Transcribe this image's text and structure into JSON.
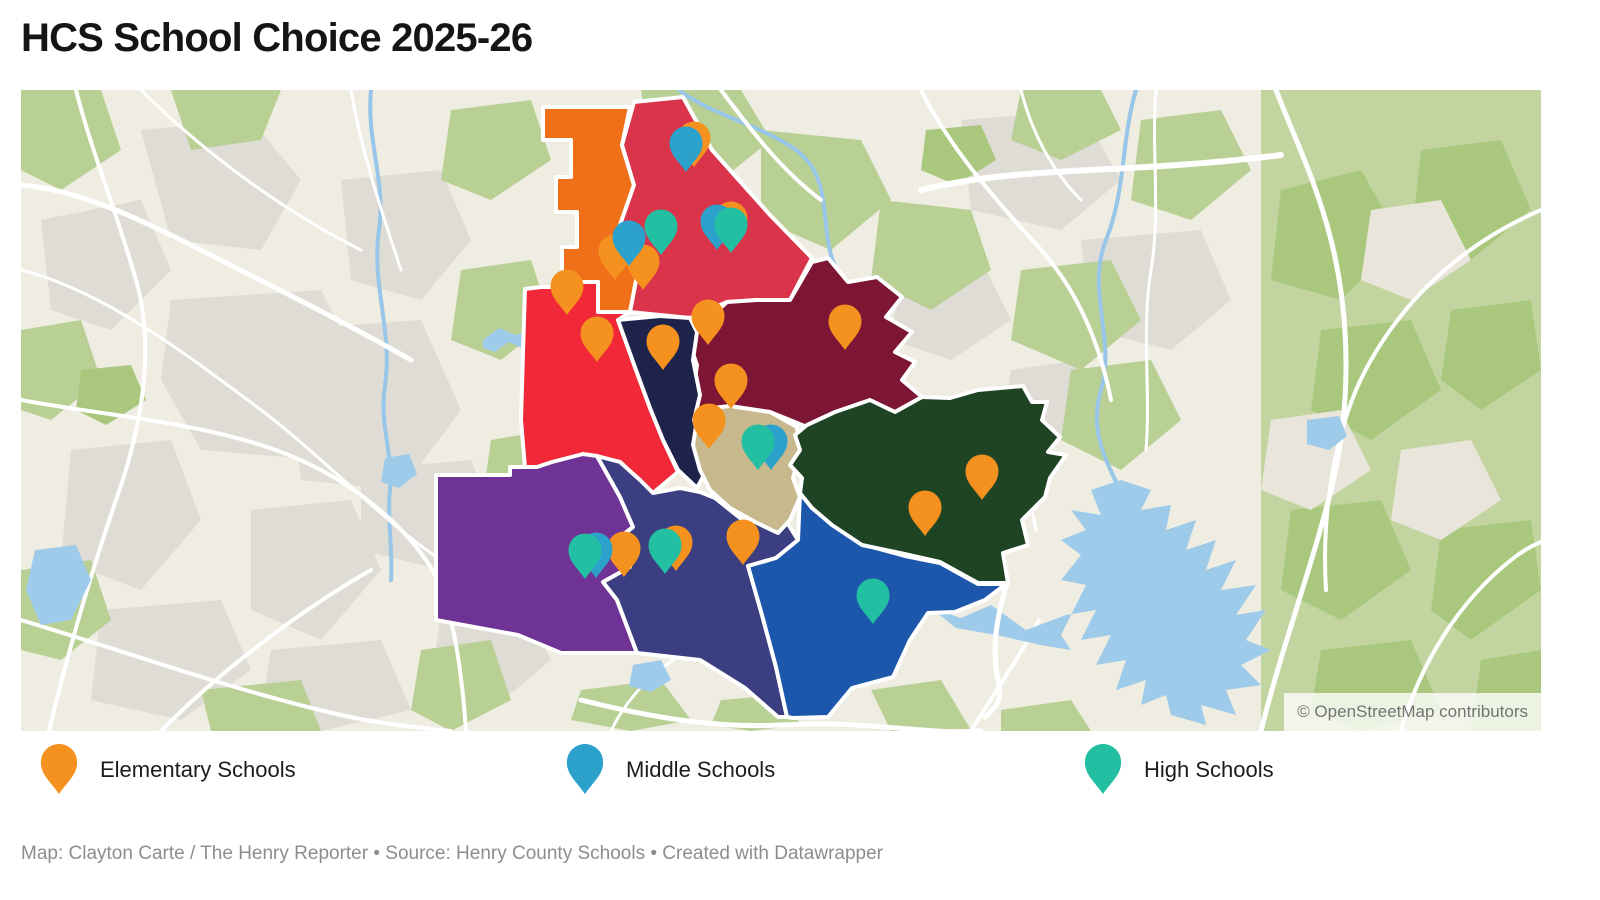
{
  "title": "HCS School Choice 2025-26",
  "legend": {
    "items": [
      {
        "type": "elementary",
        "label": "Elementary Schools",
        "color": "#F5911E"
      },
      {
        "type": "middle",
        "label": "Middle Schools",
        "color": "#2BA1CB"
      },
      {
        "type": "high",
        "label": "High Schools",
        "color": "#22BFA2"
      }
    ]
  },
  "map": {
    "attribution": "© OpenStreetMap contributors",
    "basemap_colors": {
      "land": "#EFECE2",
      "urban": "#DEDCD4",
      "vegetation": "#B9D095",
      "forest": "#C2D5A1",
      "water": "#9FCBEA",
      "road": "#FFFFFF"
    },
    "districts": [
      {
        "id": "northwest-orange",
        "color": "#F07019"
      },
      {
        "id": "north-crimson",
        "color": "#D9344A"
      },
      {
        "id": "west-red",
        "color": "#F02837"
      },
      {
        "id": "east-maroon",
        "color": "#7D1535"
      },
      {
        "id": "central-navy",
        "color": "#1D234B"
      },
      {
        "id": "central-tan",
        "color": "#C7B98D"
      },
      {
        "id": "east-green",
        "color": "#1E4423"
      },
      {
        "id": "southwest-purple",
        "color": "#6E3394"
      },
      {
        "id": "south-indigo",
        "color": "#3B3E80"
      },
      {
        "id": "southeast-blue",
        "color": "#1D57AB"
      }
    ],
    "markers": [
      {
        "type": "elementary",
        "x": 594,
        "y": 190
      },
      {
        "type": "elementary",
        "x": 622,
        "y": 200
      },
      {
        "type": "middle",
        "x": 608,
        "y": 176
      },
      {
        "type": "high",
        "x": 640,
        "y": 165
      },
      {
        "type": "elementary",
        "x": 673,
        "y": 77
      },
      {
        "type": "middle",
        "x": 665,
        "y": 82
      },
      {
        "type": "elementary",
        "x": 710,
        "y": 157
      },
      {
        "type": "middle",
        "x": 696,
        "y": 160
      },
      {
        "type": "high",
        "x": 710,
        "y": 163
      },
      {
        "type": "elementary",
        "x": 546,
        "y": 225
      },
      {
        "type": "elementary",
        "x": 576,
        "y": 272
      },
      {
        "type": "elementary",
        "x": 642,
        "y": 280
      },
      {
        "type": "elementary",
        "x": 687,
        "y": 255
      },
      {
        "type": "elementary",
        "x": 710,
        "y": 319
      },
      {
        "type": "elementary",
        "x": 688,
        "y": 359
      },
      {
        "type": "elementary",
        "x": 824,
        "y": 260
      },
      {
        "type": "middle",
        "x": 750,
        "y": 380
      },
      {
        "type": "high",
        "x": 737,
        "y": 380
      },
      {
        "type": "elementary",
        "x": 722,
        "y": 475
      },
      {
        "type": "elementary",
        "x": 603,
        "y": 487
      },
      {
        "type": "middle",
        "x": 575,
        "y": 488
      },
      {
        "type": "high",
        "x": 564,
        "y": 489
      },
      {
        "type": "elementary",
        "x": 655,
        "y": 481
      },
      {
        "type": "high",
        "x": 644,
        "y": 484
      },
      {
        "type": "elementary",
        "x": 961,
        "y": 410
      },
      {
        "type": "elementary",
        "x": 904,
        "y": 446
      },
      {
        "type": "high",
        "x": 852,
        "y": 534
      }
    ]
  },
  "footer": "Map: Clayton Carte / The Henry Reporter • Source: Henry County Schools • Created with Datawrapper"
}
